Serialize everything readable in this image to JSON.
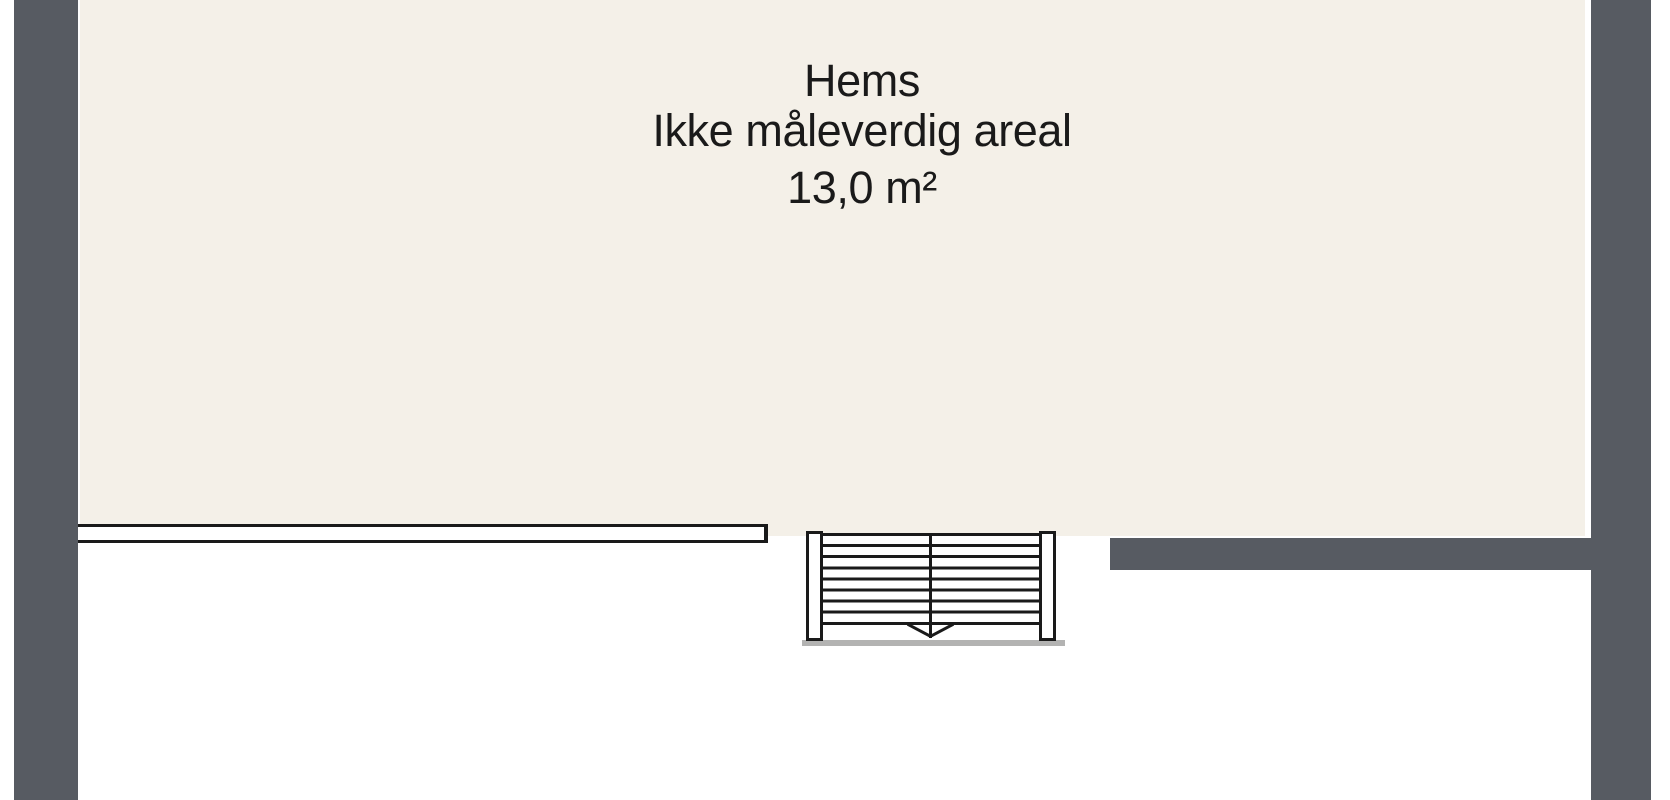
{
  "room": {
    "name": "Hems",
    "note": "Ikke måleverdig areal",
    "area": "13,0 m²"
  },
  "stair": {
    "tread_count": 8,
    "direction_arrow": "down"
  },
  "colors": {
    "background": "#ffffff",
    "wall": "#575b62",
    "floor": "#f4f0e8",
    "line": "#1a1a1a",
    "shadow": "#b3b3b2",
    "text": "#1a1a1a"
  }
}
